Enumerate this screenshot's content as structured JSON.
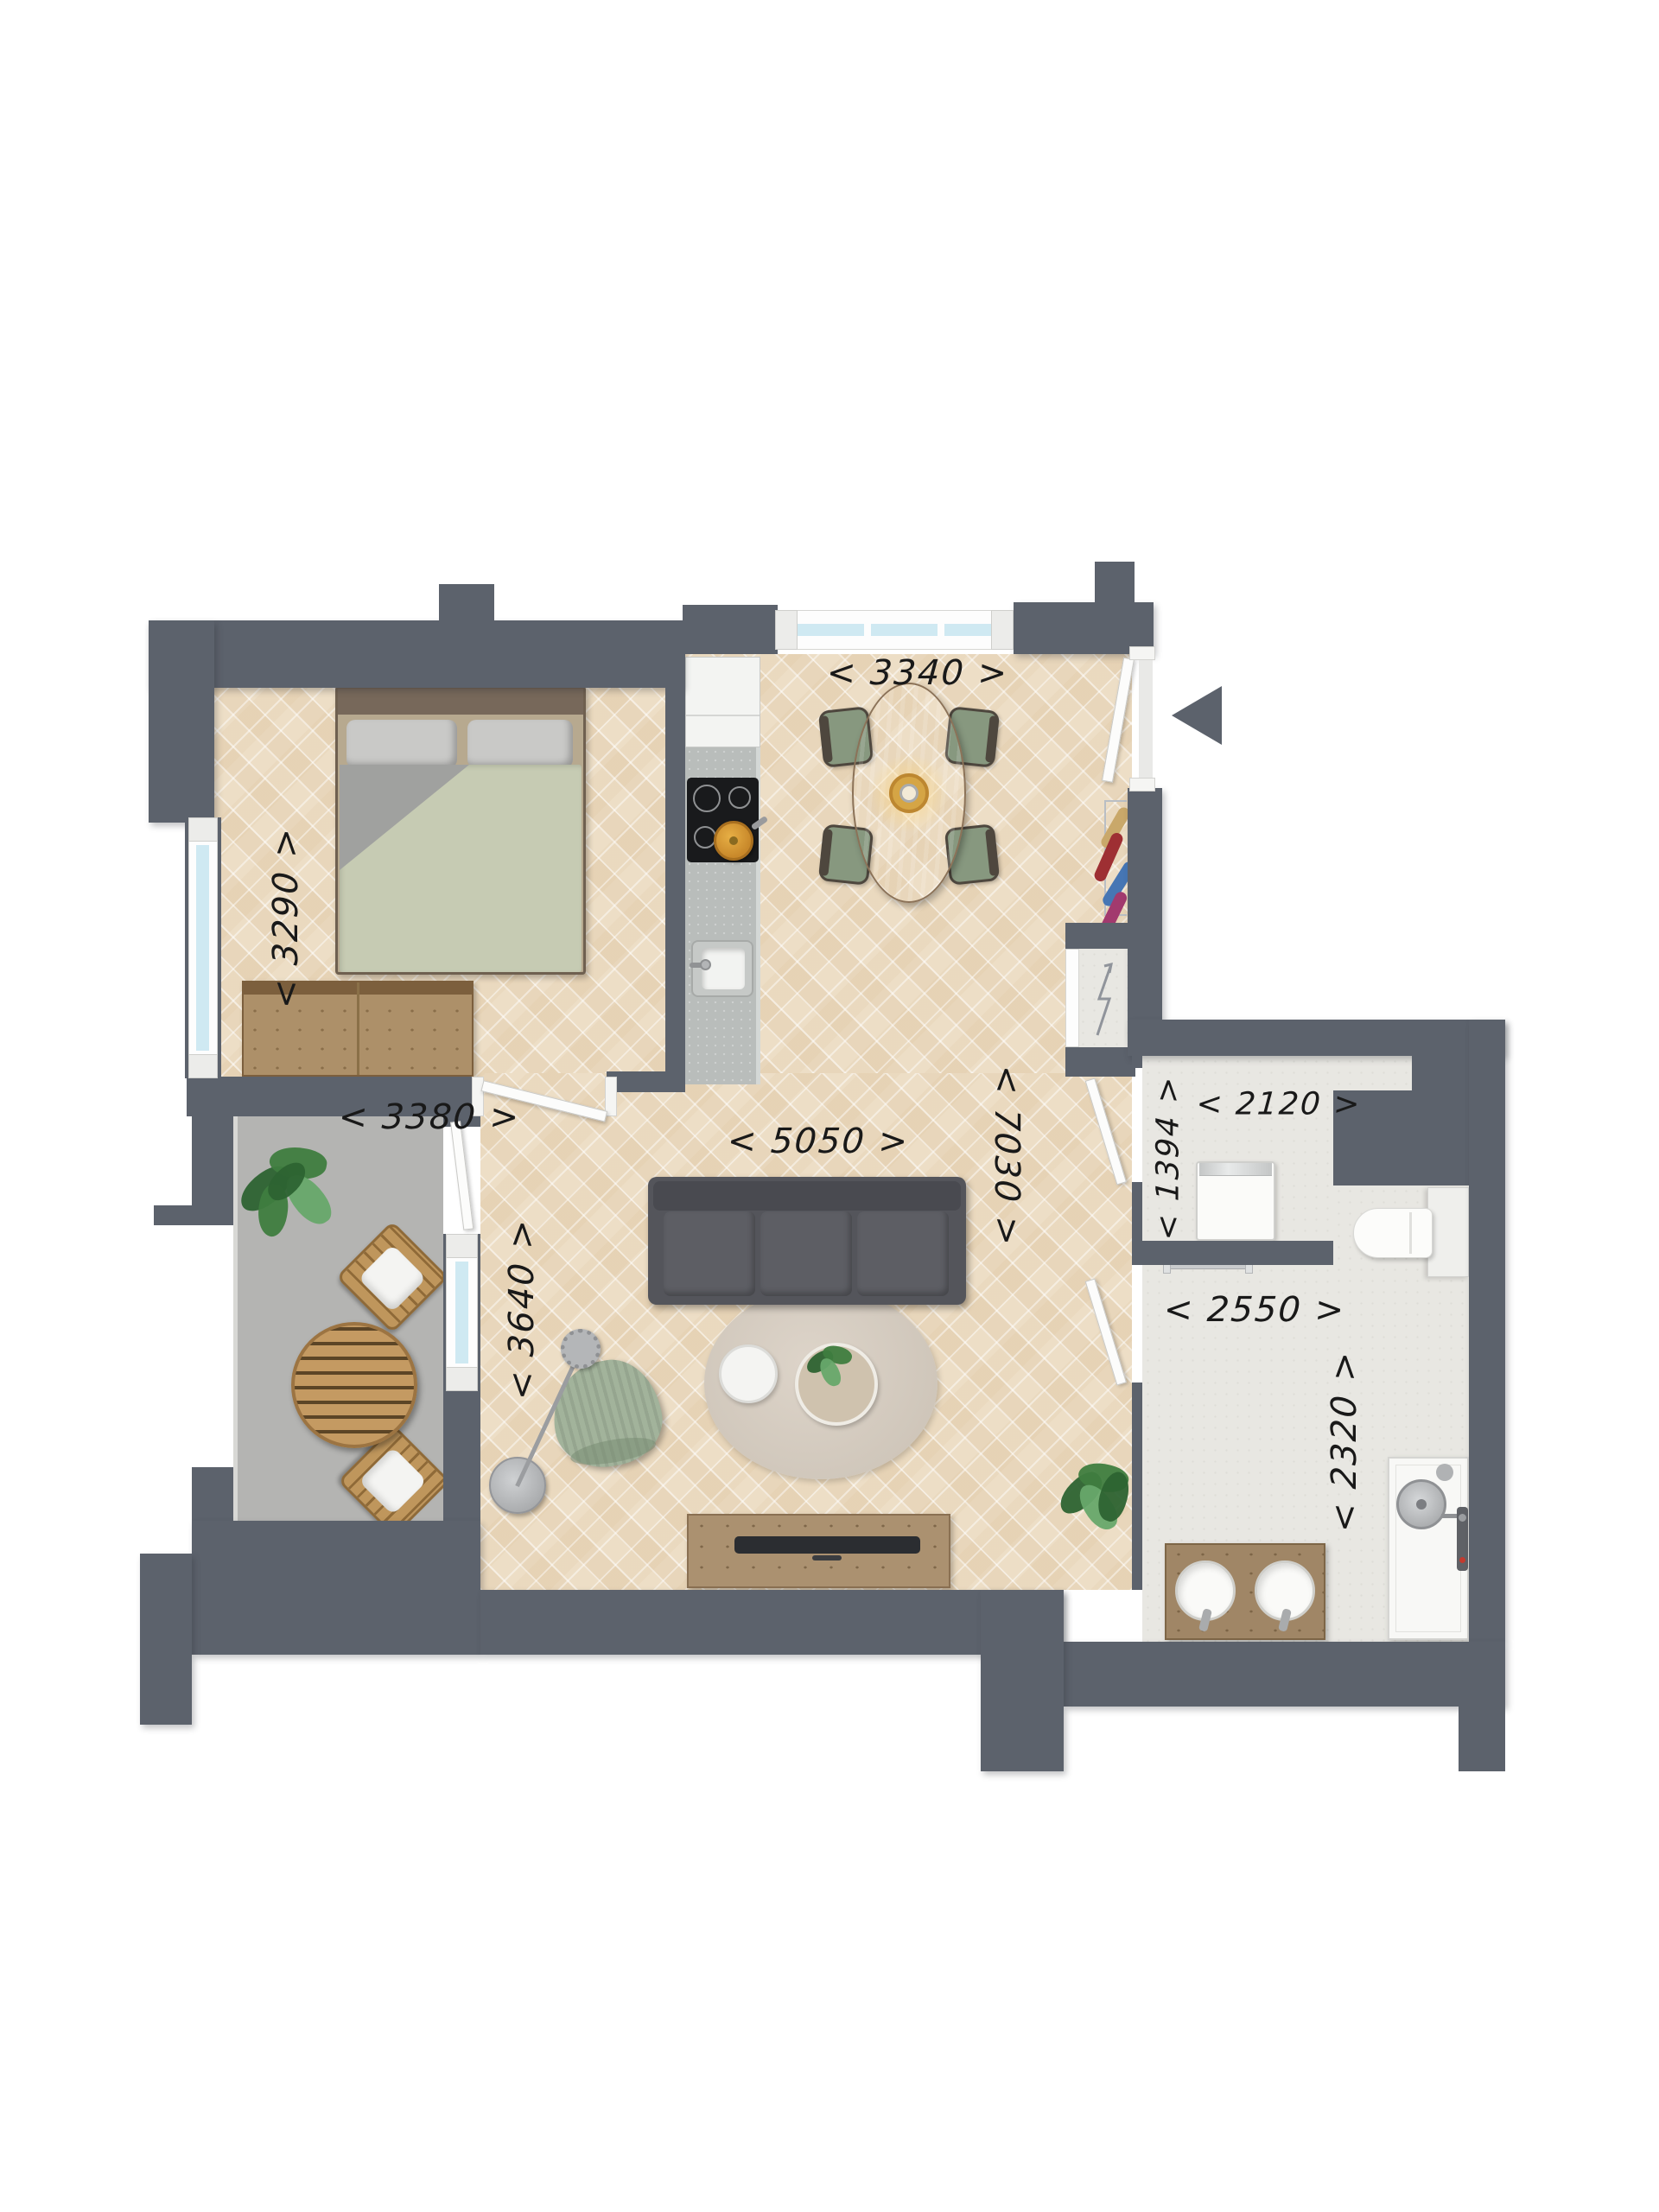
{
  "title": "apartment-floor-plan",
  "colors": {
    "wall": "#5c626c",
    "parquet": "#eddec6",
    "tile": "#b4b4b2",
    "grout": "#96969  4",
    "stonefloor": "#e8e7e2",
    "glass": "#cfe9f2",
    "label": "#191919",
    "duvet": "#c6cbb3",
    "sofa": "#54555b",
    "rug": "#d8cfc3",
    "woodLight": "#c49a62",
    "woodMid": "#ab9170",
    "woodDark": "#8a7052",
    "pot": "#d99b2e",
    "greenChair": "#a2b39b",
    "plant": "#3f7d3f"
  },
  "dimensions": {
    "dining_width": {
      "text": "< 3340 >"
    },
    "bedroom_height": {
      "text": "< 3290 >"
    },
    "bedroom_width": {
      "text": "< 3380 >"
    },
    "living_width": {
      "text": "< 5050 >"
    },
    "apartment_length": {
      "text": "< 7030 >"
    },
    "living_height": {
      "text": "< 3640 >"
    },
    "utility_depth": {
      "text": "< 1394 >"
    },
    "utility_width": {
      "text": "< 2120 >"
    },
    "bathroom_width": {
      "text": "< 2550 >"
    },
    "bathroom_depth": {
      "text": "< 2320 >"
    }
  }
}
